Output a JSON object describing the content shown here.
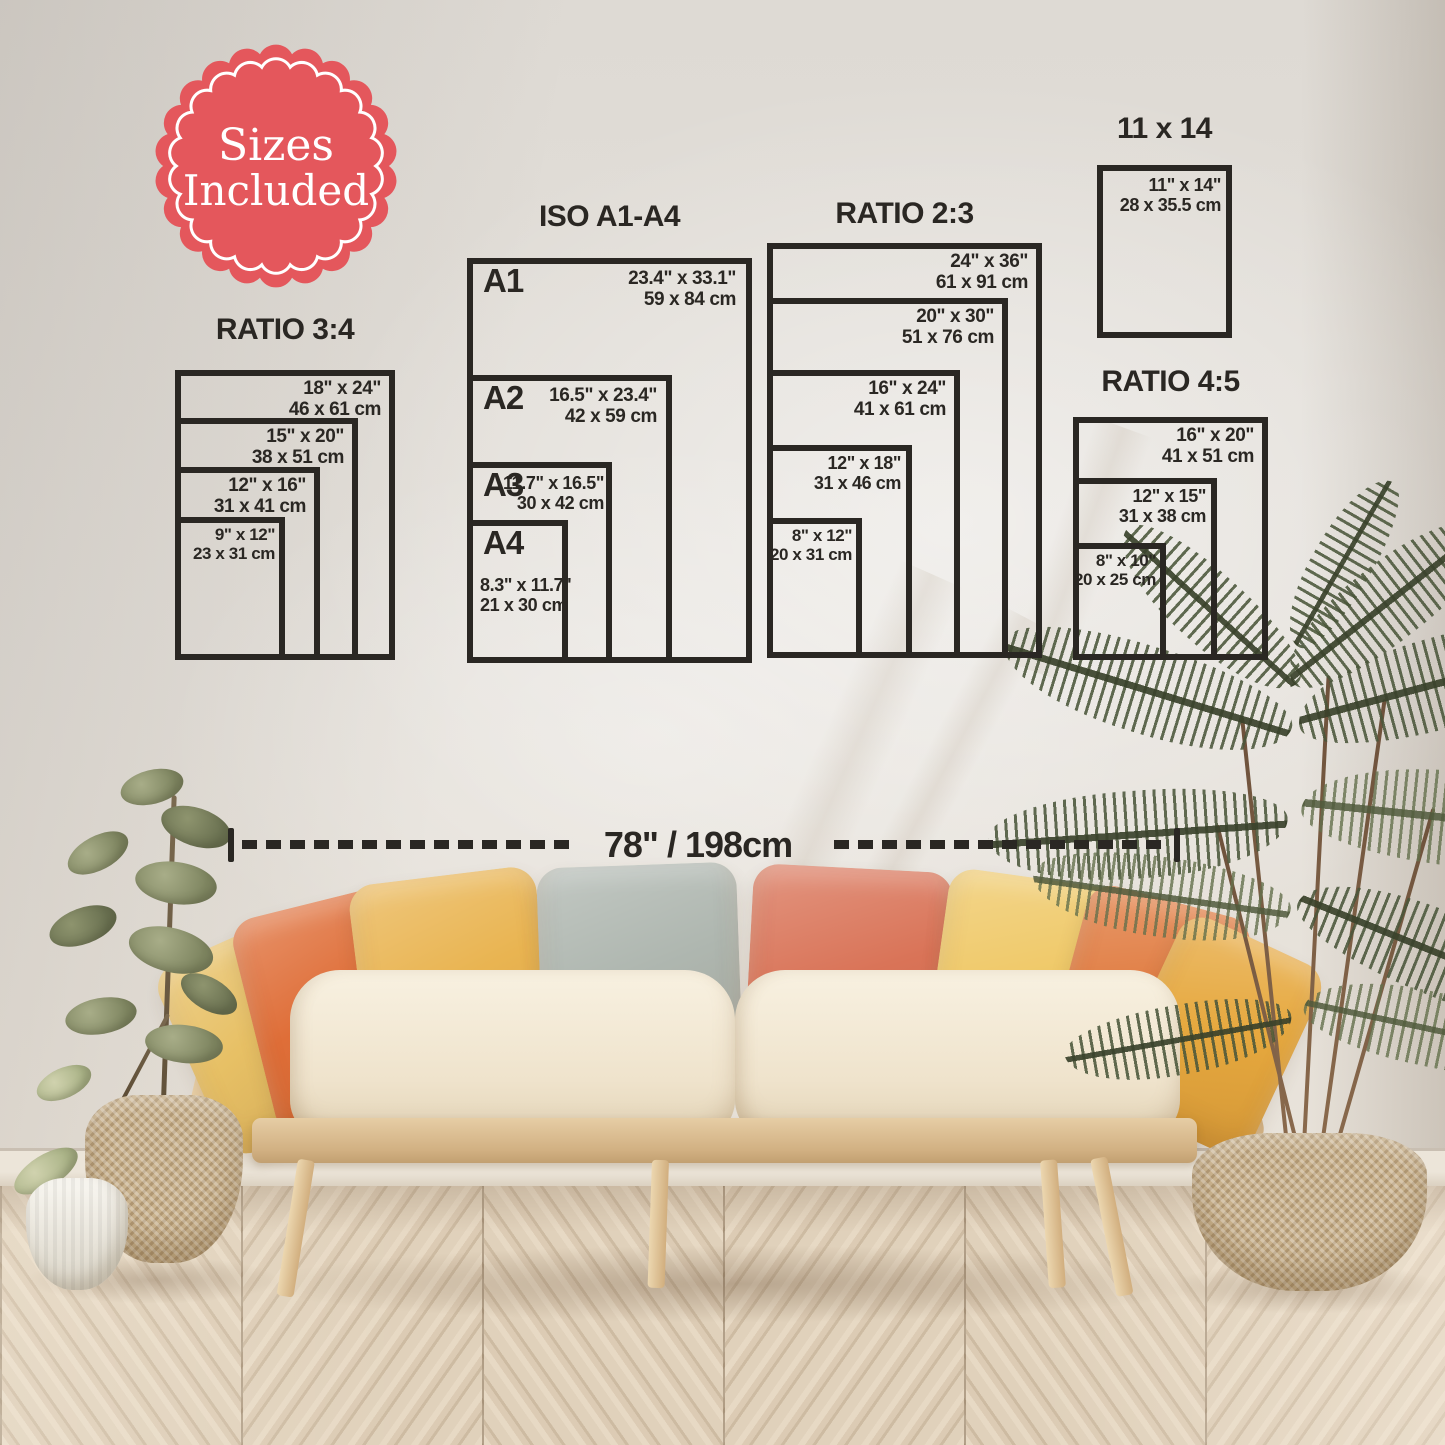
{
  "badge": {
    "line1": "Sizes",
    "line2": "Included"
  },
  "measure": {
    "label": "78\" / 198cm"
  },
  "groups": {
    "ratio34": {
      "title": "RATIO 3:4",
      "sizes": [
        {
          "inch": "18\" x 24\"",
          "cm": "46 x 61 cm"
        },
        {
          "inch": "15\" x 20\"",
          "cm": "38 x 51 cm"
        },
        {
          "inch": "12\" x 16\"",
          "cm": "31 x 41 cm"
        },
        {
          "inch": "9\" x 12\"",
          "cm": "23 x 31 cm"
        }
      ]
    },
    "iso": {
      "title": "ISO A1-A4",
      "sizes": [
        {
          "label": "A1",
          "inch": "23.4\" x 33.1\"",
          "cm": "59 x 84 cm"
        },
        {
          "label": "A2",
          "inch": "16.5\" x 23.4\"",
          "cm": "42 x 59 cm"
        },
        {
          "label": "A3",
          "inch": "11.7\" x 16.5\"",
          "cm": "30 x 42 cm"
        },
        {
          "label": "A4",
          "inch": "8.3\" x 11.7\"",
          "cm": "21 x 30 cm"
        }
      ]
    },
    "ratio23": {
      "title": "RATIO 2:3",
      "sizes": [
        {
          "inch": "24\" x 36\"",
          "cm": "61 x 91 cm"
        },
        {
          "inch": "20\" x 30\"",
          "cm": "51 x 76 cm"
        },
        {
          "inch": "16\" x 24\"",
          "cm": "41 x 61 cm"
        },
        {
          "inch": "12\" x 18\"",
          "cm": "31 x 46 cm"
        },
        {
          "inch": "8\" x 12\"",
          "cm": "20 x 31 cm"
        }
      ]
    },
    "size11x14": {
      "title": "11 x 14",
      "sizes": [
        {
          "inch": "11\" x 14\"",
          "cm": "28 x 35.5 cm"
        }
      ]
    },
    "ratio45": {
      "title": "RATIO 4:5",
      "sizes": [
        {
          "inch": "16\" x 20\"",
          "cm": "41 x 51 cm"
        },
        {
          "inch": "12\" x 15\"",
          "cm": "31 x 38 cm"
        },
        {
          "inch": "8\" x 10\"",
          "cm": "20 x 25 cm"
        }
      ]
    }
  },
  "palette": {
    "ink": "#2a2723",
    "badge_red": "#e4575c",
    "wall": "#e3dfd9",
    "floor": "#d8c8b2",
    "wood": "#dec49c",
    "cushion": "#f3ead8",
    "pillows": [
      "#e7c065",
      "#df6e38",
      "#e9b451",
      "#aeb6af",
      "#d97357",
      "#efc866",
      "#e07a3e",
      "#e6a83e"
    ],
    "leaf_green": "#8b9169",
    "palm_green": "#4c573c",
    "basket": "#c9b28d"
  }
}
